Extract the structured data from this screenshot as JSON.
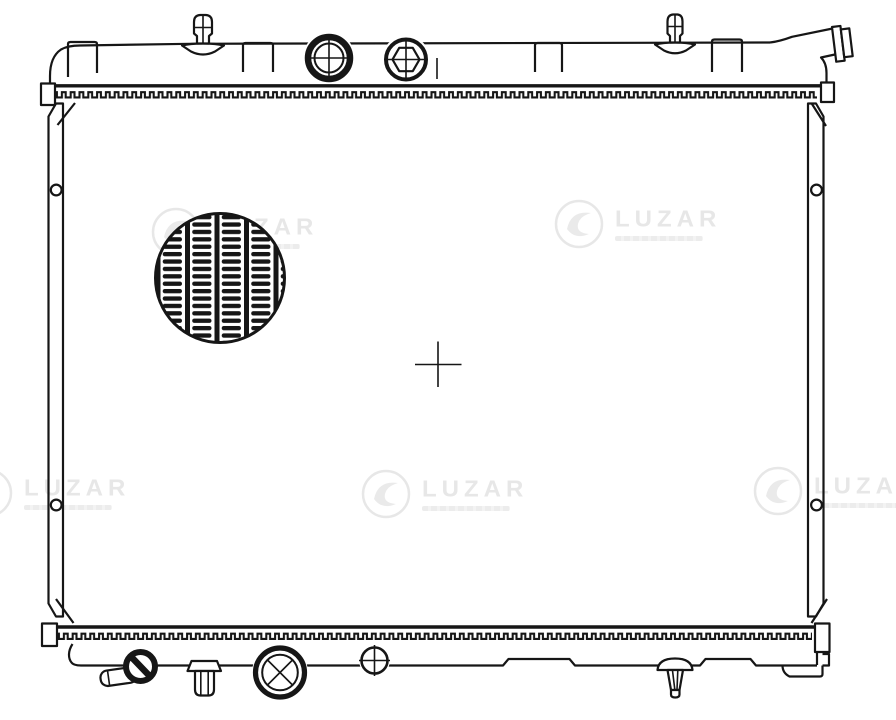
{
  "document": {
    "type": "technical-line-drawing",
    "subject": "automotive radiator, front view",
    "background": "#ffffff",
    "line_color": "#161616"
  },
  "watermark": {
    "brand": "LUZAR",
    "color": "#e7e7e7",
    "instances": 5
  },
  "parts": [
    "top-tank",
    "mounting-tab",
    "bleed-valve",
    "filler-cap",
    "hex-drain-plug",
    "inlet-pipe",
    "crimp-band-top",
    "side-bracket-left",
    "side-bracket-right",
    "mounting-hole",
    "core-grille-detail",
    "center-mark",
    "crimp-band-bottom",
    "bottom-tank",
    "drain-cock",
    "drain-pipe",
    "outlet-port",
    "service-port",
    "mounting-pin",
    "bracket-foot-right"
  ]
}
